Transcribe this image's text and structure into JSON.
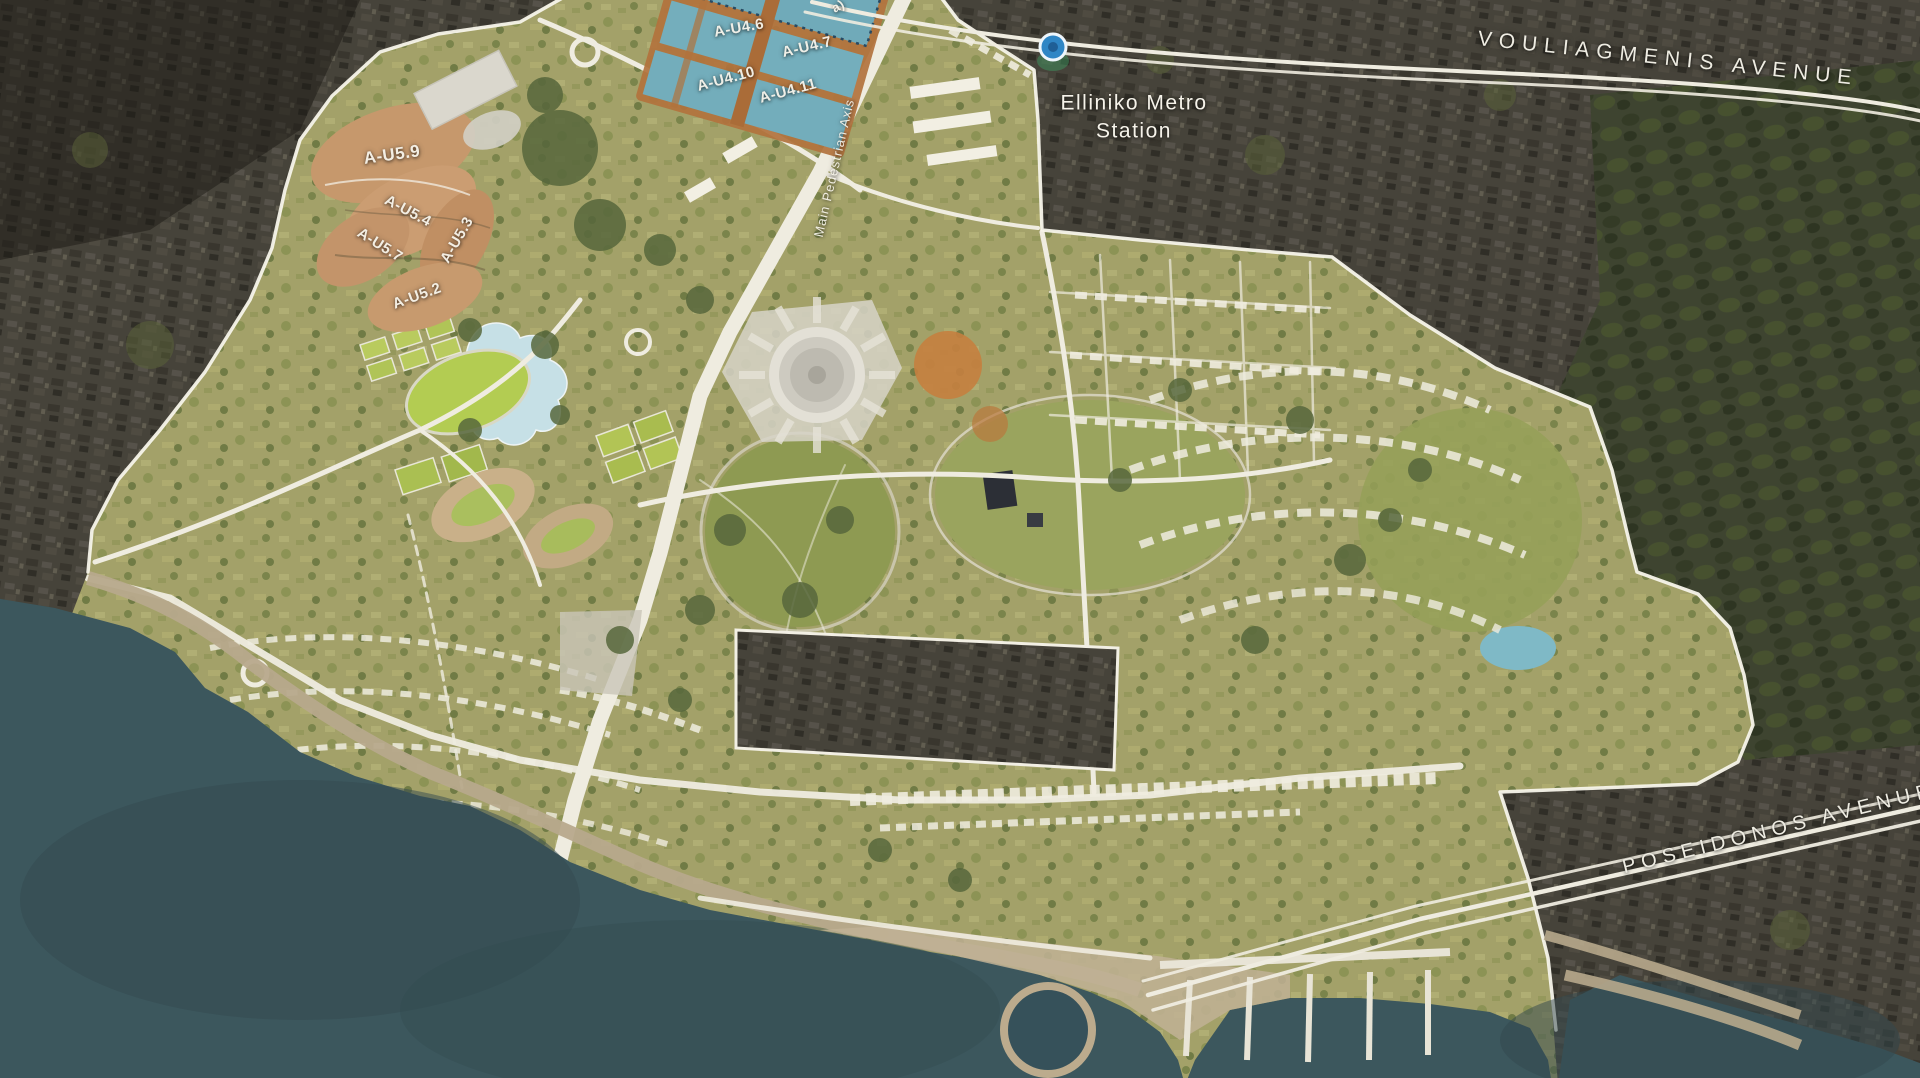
{
  "labels": {
    "vouliagmenis": "VOULIAGMENIS AVENUE",
    "poseidonos": "POSEIDONOS AVENUE",
    "metro_line1": "Elliniko Metro",
    "metro_line2": "Station",
    "main_axis": "Main Pedestrian Axis",
    "partial_parcel": "a)"
  },
  "parcels": {
    "blue": [
      {
        "label": "A-U4.6"
      },
      {
        "label": "A-U4.7"
      },
      {
        "label": "A-U4.10"
      },
      {
        "label": "A-U4.11"
      }
    ],
    "orange": [
      {
        "label": "A-U5.9"
      },
      {
        "label": "A-U5.4"
      },
      {
        "label": "A-U5.7"
      },
      {
        "label": "A-U5.3"
      },
      {
        "label": "A-U5.2"
      }
    ]
  },
  "icons": {
    "metro": "metro-station-icon"
  },
  "colors": {
    "sea": "#3c575d",
    "city": "#45423a",
    "forest": "#3e4430",
    "site": "#a3a169",
    "road": "#efece0",
    "boundary": "#f7f4ea",
    "parcel_blue": "#74aebc",
    "parcel_orange": "#c6986c",
    "lake": "#c6e0e6",
    "pond": "#7fb9c6",
    "sand": "#b7a98c",
    "metro_blue": "#2f86c5",
    "park": "#8e9a52"
  }
}
